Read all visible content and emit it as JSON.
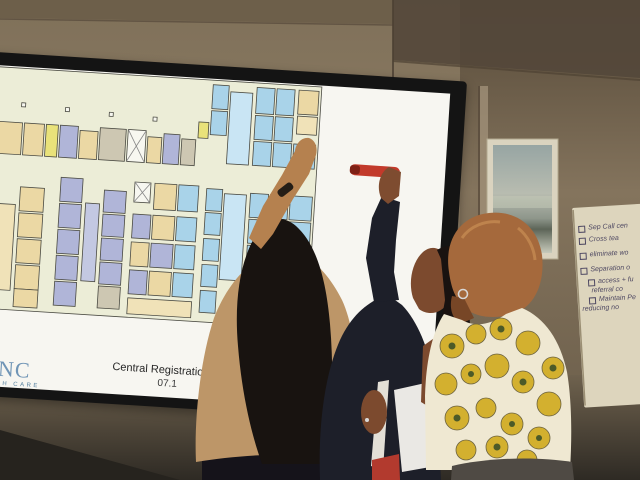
{
  "slide": {
    "title": "ING THE REGISTRATION & WAITING WE WANT!!",
    "directions_tab": "S",
    "sidebar_lines": [
      "ams of 4 or",
      "with",
      "roles.",
      "",
      "e cut-out",
      "pieces and",
      "arrange",
      "ents, draw",
      "lines,",
      "toons,",
      "",
      "hic,",
      "our vision!"
    ],
    "caption_title": "Central Registratio",
    "caption_date": "07.1",
    "logo_left_top": "NC",
    "logo_left_bottom": "TH CARE",
    "logo_right": "LS"
  },
  "flipchart": {
    "items": [
      {
        "text": "Sep Call cen"
      },
      {
        "text": "Cross tea"
      },
      {
        "text": "eliminate wo"
      },
      {
        "text": "Separation o"
      },
      {
        "text": "access + fu"
      },
      {
        "text": "referral co"
      },
      {
        "text": "Maintain Pe"
      },
      {
        "text": "reducing no"
      }
    ]
  },
  "palette": {
    "wall": "#8a7a63",
    "tv_bezel": "#141414",
    "slide_bg": "#f7f6f1",
    "plan_bg": "#ecedd7",
    "room_blue": "#a9d3e9",
    "room_tan": "#ebd8a4",
    "room_lavender": "#b0b5d8",
    "room_yellow": "#e9e27a",
    "corridor_blue": "#c9e5f4",
    "marker_red": "#c23a2b",
    "sweater_tan": "#bd9668",
    "blazer_navy": "#1d1f29",
    "floral_yellow": "#d3b02f",
    "flipchart_paper": "#ddd5bd"
  }
}
